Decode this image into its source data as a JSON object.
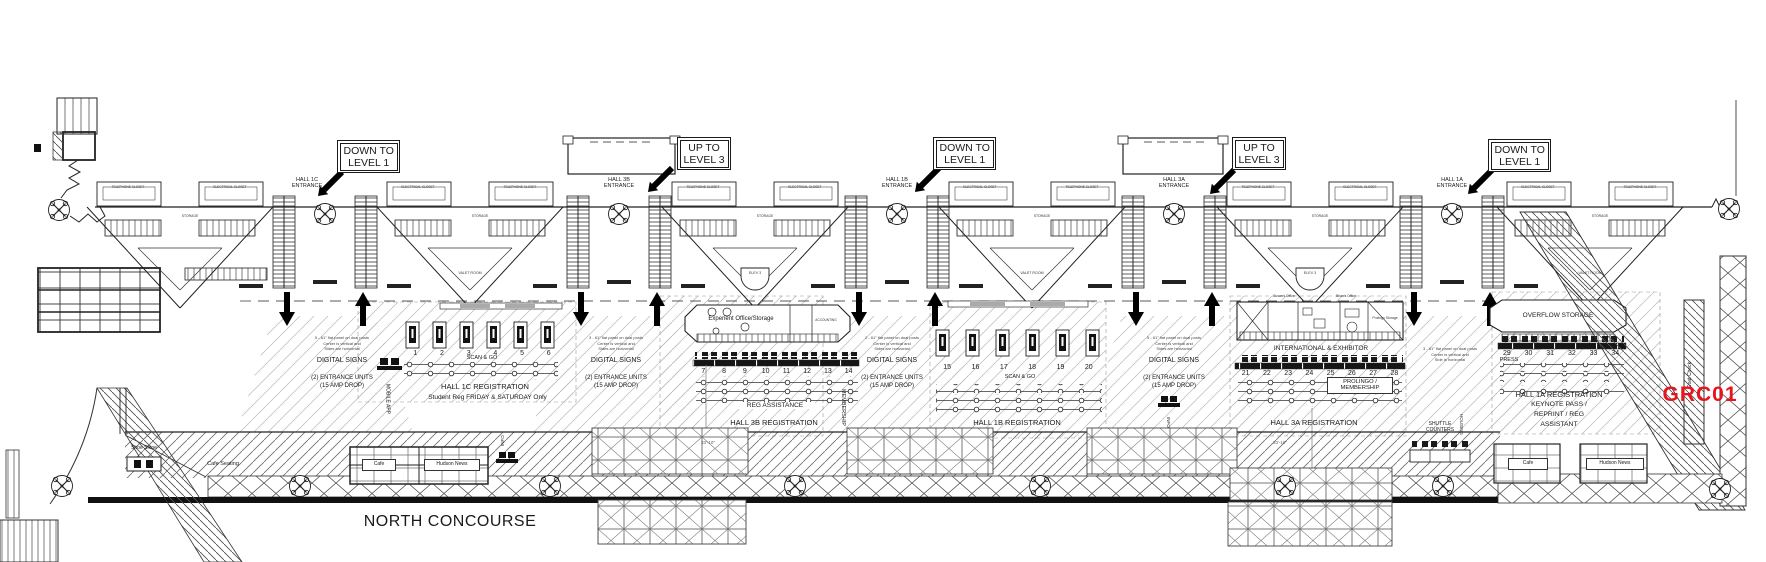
{
  "code": {
    "text": "GRC01",
    "color": "#e8141c"
  },
  "concourse": {
    "title": "NORTH CONCOURSE",
    "shoe_shine": "Shoe Shine",
    "cafe_seating": "Cafe Seating",
    "cafe_left": "Cafe",
    "hudson_left": "Hudson News",
    "cafe_right": "Cafe",
    "hudson_right": "Hudson News",
    "shuttle1": "SHUTTLE",
    "shuttle2": "COUNTERS",
    "housing": "HOUSING",
    "coat_check": "Coat Check",
    "info_left": "INFO"
  },
  "signs": [
    {
      "l1": "DOWN TO",
      "l2": "LEVEL 1"
    },
    {
      "l1": "UP TO",
      "l2": "LEVEL 3"
    },
    {
      "l1": "DOWN TO",
      "l2": "LEVEL 1"
    },
    {
      "l1": "UP TO",
      "l2": "LEVEL 3"
    },
    {
      "l1": "DOWN TO",
      "l2": "LEVEL 1"
    }
  ],
  "entrances": [
    {
      "l1": "HALL 1C",
      "l2": "ENTRANCE"
    },
    {
      "l1": "HALL 3B",
      "l2": "ENTRANCE"
    },
    {
      "l1": "HALL 1B",
      "l2": "ENTRANCE"
    },
    {
      "l1": "HALL 3A",
      "l2": "ENTRANCE"
    },
    {
      "l1": "HALL 1A",
      "l2": "ENTRANCE"
    }
  ],
  "pods": [
    {
      "left": "TELEPHONE CLOSET",
      "right": "ELECTRICAL CLOSET",
      "storage": "STORAGE",
      "inner": ""
    },
    {
      "left": "ELECTRICAL CLOSET",
      "right": "TELEPHONE CLOSET",
      "storage": "STORAGE",
      "inner": "VALET ROOM"
    },
    {
      "left": "TELEPHONE CLOSET",
      "right": "ELECTRICAL CLOSET",
      "storage": "STORAGE",
      "inner": "ELEV 3"
    },
    {
      "left": "ELECTRICAL CLOSET",
      "right": "TELEPHONE CLOSET",
      "storage": "STORAGE",
      "inner": "VALET ROOM"
    },
    {
      "left": "TELEPHONE CLOSET",
      "right": "ELECTRICAL CLOSET",
      "storage": "STORAGE",
      "inner": "ELEV 3"
    },
    {
      "left": "ELECTRICAL CLOSET",
      "right": "TELEPHONE CLOSET",
      "storage": "STORAGE",
      "inner": "VALET ROOM"
    }
  ],
  "sign_sets": [
    {
      "n1": "5 - 61\" flat panel on dual posts",
      "n2": "Center is vertical and",
      "n3": "Sides are horizontal",
      "title": "DIGITAL SIGNS",
      "u1": "(2) ENTRANCE UNITS",
      "u2": "(15 AMP DROP)"
    },
    {
      "n1": "3 - 61\" flat panel on dual posts",
      "n2": "Center is vertical and",
      "n3": "Sides are horizontal",
      "title": "DIGITAL SIGNS",
      "u1": "(2) ENTRANCE UNITS",
      "u2": "(15 AMP DROP)"
    },
    {
      "n1": "2 - 61\" flat panel on dual posts",
      "n2": "Center is vertical and",
      "n3": "Sides are horizontal",
      "title": "DIGITAL SIGNS",
      "u1": "(2) ENTRANCE UNITS",
      "u2": "(15 AMP DROP)"
    },
    {
      "n1": "5 - 61\" flat panel on dual posts",
      "n2": "Center is vertical and",
      "n3": "Sides are horizontal",
      "title": "DIGITAL SIGNS",
      "u1": "(2) ENTRANCE UNITS",
      "u2": "(15 AMP DROP)"
    },
    {
      "n1": "3 - 61\" flat panel on dual posts",
      "n2": "Center is vertical and",
      "n3": "Side is horizontal"
    }
  ],
  "hall_1c": {
    "numbers": [
      "1",
      "2",
      "3",
      "4",
      "5",
      "6"
    ],
    "scan_go": "SCAN & GO",
    "title": "HALL 1C REGISTRATION",
    "subtitle": "Student Reg FRIDAY & SATURDAY Only",
    "mobile_app": "MOBILE APP"
  },
  "hall_3b": {
    "office": "Experient Office/Storage",
    "accounting": "ACCOUNTING",
    "numbers": [
      "7",
      "8",
      "9",
      "10",
      "11",
      "12",
      "13",
      "14"
    ],
    "reg_assistance": "REG ASSISTANCE",
    "title": "HALL 3B REGISTRATION",
    "membership": "MEMBERSHIP",
    "dim": "33'-10\""
  },
  "hall_1b": {
    "numbers": [
      "15",
      "16",
      "17",
      "18",
      "19",
      "20"
    ],
    "scan_go": "SCAN & GO",
    "title": "HALL 1B REGISTRATION",
    "info": "INFO"
  },
  "hall_3a": {
    "susan": "Susan's Office",
    "brian": "Brian's Office",
    "prolingo_storage": "Prolingo Storage",
    "intl": "INTERNATIONAL & EXHIBITOR",
    "numbers": [
      "21",
      "22",
      "23",
      "24",
      "25",
      "26",
      "27",
      "28"
    ],
    "prolingo1": "PROLINGO /",
    "prolingo2": "MEMBERSHIP",
    "title": "HALL 3A REGISTRATION",
    "dim": "33'-10\""
  },
  "hall_1a": {
    "overflow": "OVERFLOW STORAGE",
    "numbers": [
      "29",
      "30",
      "31",
      "32",
      "33",
      "34"
    ],
    "press": "PRESS",
    "title": "HALL 1A REGISTRATION",
    "l2": "KEYNOTE PASS /",
    "l3": "REPRINT / REG",
    "l4": "ASSISTANT"
  }
}
